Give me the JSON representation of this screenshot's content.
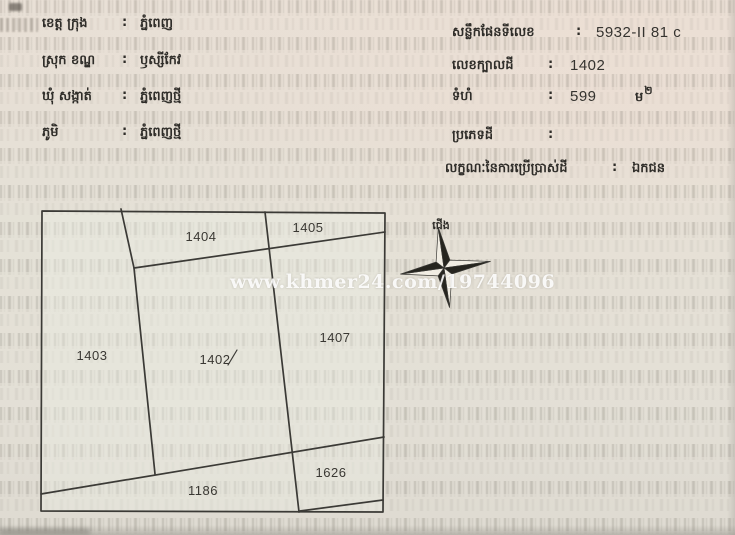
{
  "document_header_left": {
    "rows": [
      {
        "label": "ខេត្ត ក្រុង",
        "colon": ":",
        "value": "ភ្នំពេញ"
      },
      {
        "label": "ស្រុក ខណ្ឌ",
        "colon": ":",
        "value": "ឫស្សីកែវ"
      },
      {
        "label": "ឃុំ សង្កាត់",
        "colon": ":",
        "value": "ភ្នំពេញថ្មី"
      },
      {
        "label": "ភូមិ",
        "colon": ":",
        "value": "ភ្នំពេញថ្មី"
      }
    ]
  },
  "document_header_right": {
    "rows": [
      {
        "label": "សន្លឹកផែនទីលេខ",
        "colon": ":",
        "value": "5932-II 81 c"
      },
      {
        "label": "លេខក្បាលដី",
        "colon": ":",
        "value": "1402"
      },
      {
        "label": "ទំហំ",
        "colon": ":",
        "value": "599",
        "unit": "ម",
        "unit_sup": "២"
      },
      {
        "label": "ប្រភេទដី",
        "colon": ":",
        "value": ""
      },
      {
        "label": "លក្ខណៈនៃការប្រើប្រាស់ដី",
        "colon": ":",
        "value": "ឯកជន"
      }
    ]
  },
  "map": {
    "north_label": "ជើង",
    "parcel_numbers": [
      "1404",
      "1405",
      "1403",
      "1402",
      "1407",
      "1186",
      "1626"
    ]
  },
  "watermark": {
    "text": "www.khmer24.com/19744096"
  },
  "colors": {
    "paper": "#e5dfd5",
    "ink": "#2f2d29",
    "map_line": "#3b3a36",
    "watermark_text": "#ffffff",
    "compass_dark": "#26251f"
  }
}
